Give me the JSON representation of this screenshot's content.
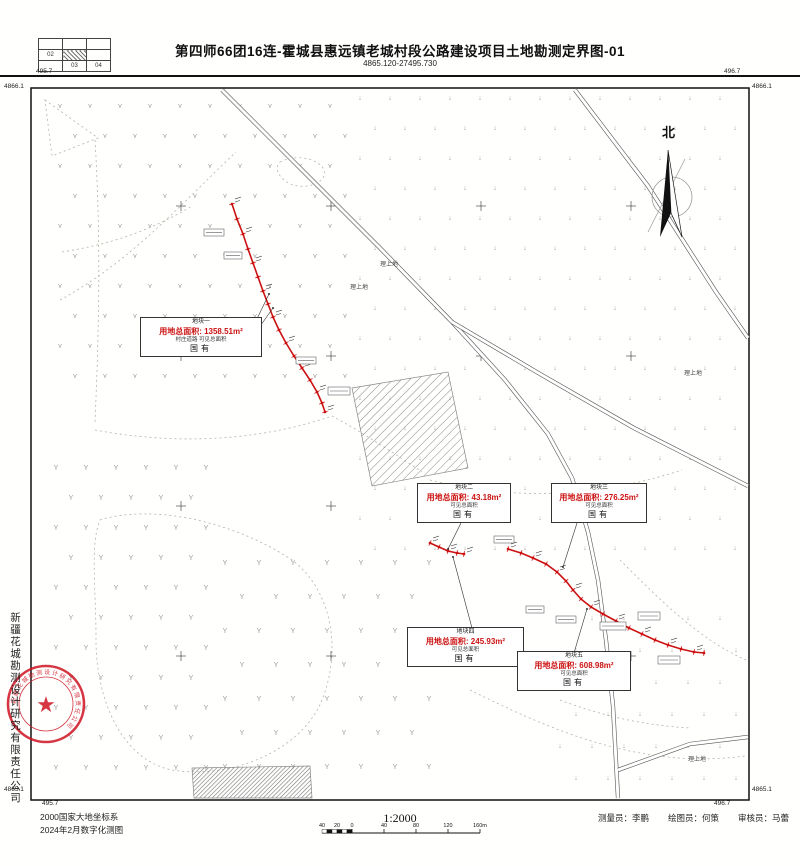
{
  "header": {
    "cells": [
      "02",
      "03",
      "04"
    ],
    "title": "第四师66团16连-霍城县惠远镇老城村段公路建设项目土地勘测定界图-01",
    "subtitle": "4865.120-27495.730"
  },
  "north_label": "北",
  "company_vertical": "新疆花城勘测设计研究有限责任公司",
  "seal": {
    "ring_text": "新疆花城勘测设计研究有限责任公司",
    "star": "★"
  },
  "corners": {
    "top_left_top": "495.7",
    "top_left_side": "4866.1",
    "top_right_top": "496.7",
    "top_right_side": "4866.1",
    "bottom_left_side": "4865.1",
    "bottom_left_bottom": "495.7",
    "bottom_right_side": "4865.1",
    "bottom_right_bottom": "496.7"
  },
  "footer": {
    "crs": "2000国家大地坐标系",
    "survey_date": "2024年2月数字化测图",
    "scale_text": "1:2000",
    "scale_ticks": [
      "40",
      "20",
      "0",
      "40",
      "80",
      "120",
      "160m"
    ],
    "surveyor_label": "测量员：李鹏",
    "drafter_label": "绘图员：何策",
    "reviewer_label": "审核员：马蕾"
  },
  "parcels": [
    {
      "name": "地块一",
      "area": "用地总面积: 1358.51m²",
      "sub": "村庄道路 可见总面积",
      "tenure": "国有",
      "x": 140,
      "y": 317,
      "w": 116,
      "h": 45
    },
    {
      "name": "地块二",
      "area": "用地总面积: 43.18m²",
      "sub": "可见总面积",
      "tenure": "国有",
      "x": 417,
      "y": 483,
      "w": 88,
      "h": 43
    },
    {
      "name": "地块三",
      "area": "用地总面积: 276.25m²",
      "sub": "可见总面积",
      "tenure": "国有",
      "x": 551,
      "y": 483,
      "w": 90,
      "h": 43
    },
    {
      "name": "地块四",
      "area": "用地总面积: 245.93m²",
      "sub": "可见总面积",
      "tenure": "国有",
      "x": 407,
      "y": 627,
      "w": 111,
      "h": 45
    },
    {
      "name": "地块五",
      "area": "用地总面积: 608.98m²",
      "sub": "可见总面积",
      "tenure": "国有",
      "x": 517,
      "y": 651,
      "w": 108,
      "h": 47
    }
  ],
  "land_labels": [
    {
      "text": "理上地",
      "x": 380,
      "y": 259
    },
    {
      "text": "理上地",
      "x": 350,
      "y": 282
    },
    {
      "text": "理上地",
      "x": 684,
      "y": 368
    },
    {
      "text": "理上地",
      "x": 688,
      "y": 754
    }
  ],
  "colors": {
    "route_red": "#cc1111",
    "seal_red": "#cf1322",
    "road_gray": "#555",
    "symbol_gray": "#9a9a9a"
  },
  "map": {
    "frame": {
      "x": 31,
      "y": 88,
      "w": 718,
      "h": 712
    },
    "symbol_regions": [
      {
        "glyph": "⋎",
        "x0": 60,
        "y0": 108,
        "x1": 345,
        "y1": 385,
        "step": 30
      },
      {
        "glyph": "↓",
        "x0": 360,
        "y0": 100,
        "x1": 742,
        "y1": 560,
        "step": 30
      },
      {
        "glyph": "↓",
        "x0": 560,
        "y0": 620,
        "x1": 742,
        "y1": 795,
        "step": 32
      },
      {
        "glyph": "Y",
        "x0": 56,
        "y0": 470,
        "x1": 210,
        "y1": 795,
        "step": 30
      },
      {
        "glyph": "Y",
        "x0": 225,
        "y0": 565,
        "x1": 430,
        "y1": 790,
        "step": 34
      }
    ],
    "grid_crosses": {
      "xs": [
        181,
        331,
        481,
        631
      ],
      "ys": [
        206,
        356,
        506,
        656
      ]
    },
    "roads": [
      "M222,90 L300,168 L380,248 L452,322 L505,380 L548,434 L572,478 L588,532 L598,580 L606,640 L613,706 L618,798",
      "M452,322 L540,374 L634,428 L748,486",
      "M575,90 L648,186 L716,292 L748,338",
      "M618,770 L690,744 L748,737"
    ],
    "dashed_paths": [
      "M60,300 C130,262 180,205 236,152",
      "M62,252 C112,244 152,230 192,206",
      "M95,140 C101,240 99,330 95,422",
      "M95,430 C180,446 262,440 332,416",
      "M332,416 C362,432 392,452 422,472",
      "M100,520 C150,504 232,520 292,560 C332,590 342,650 322,700 C302,750 232,780 172,770 C122,760 96,700 96,640 C96,588 90,544 100,520 Z",
      "M430,480 C520,502 602,496 682,470",
      "M470,690 C550,730 642,770 745,756",
      "M620,560 C660,600 700,640 746,660",
      "M280,162 C295,154 316,158 323,168 C329,178 316,188 298,186 C283,184 272,170 280,162 Z",
      "M45,100 L98,138 L52,156 Z",
      "M560,700 C600,715 640,725 690,728"
    ],
    "hatch_fields": [
      {
        "points": "352,388 448,372 468,468 372,486",
        "pattern": "hatchLight"
      },
      {
        "points": "192,768 310,766 312,798 194,798",
        "pattern": "hatchDense"
      }
    ],
    "routes": [
      {
        "points": [
          [
            232,
            204
          ],
          [
            237,
            219
          ],
          [
            243,
            234
          ],
          [
            248,
            249
          ],
          [
            253,
            263
          ],
          [
            258,
            277
          ],
          [
            263,
            291
          ],
          [
            268,
            304
          ],
          [
            273,
            317
          ],
          [
            279,
            330
          ],
          [
            286,
            343
          ],
          [
            294,
            356
          ],
          [
            302,
            368
          ],
          [
            310,
            380
          ],
          [
            317,
            392
          ],
          [
            322,
            403
          ],
          [
            325,
            412
          ]
        ]
      },
      {
        "points": [
          [
            430,
            543
          ],
          [
            439,
            547
          ],
          [
            448,
            551
          ],
          [
            457,
            553
          ],
          [
            464,
            554
          ]
        ]
      },
      {
        "points": [
          [
            508,
            549
          ],
          [
            521,
            553
          ],
          [
            533,
            558
          ],
          [
            546,
            564
          ],
          [
            557,
            572
          ],
          [
            566,
            581
          ],
          [
            573,
            590
          ],
          [
            581,
            599
          ],
          [
            591,
            607
          ],
          [
            603,
            614
          ],
          [
            616,
            621
          ],
          [
            629,
            628
          ],
          [
            642,
            634
          ],
          [
            655,
            640
          ],
          [
            668,
            645
          ],
          [
            681,
            649
          ],
          [
            694,
            652
          ],
          [
            704,
            653
          ]
        ]
      }
    ],
    "leaders": [
      [
        253,
        327,
        269,
        294
      ],
      [
        253,
        336,
        273,
        308
      ],
      [
        461,
        523,
        448,
        549
      ],
      [
        577,
        523,
        563,
        567
      ],
      [
        472,
        628,
        453,
        557
      ],
      [
        574,
        653,
        587,
        609
      ]
    ],
    "micro_boxes": [
      [
        600,
        622,
        26,
        8
      ],
      [
        638,
        612,
        22,
        8
      ],
      [
        556,
        616,
        20,
        7
      ],
      [
        526,
        606,
        18,
        7
      ],
      [
        658,
        656,
        22,
        8
      ],
      [
        224,
        252,
        18,
        7
      ],
      [
        204,
        229,
        20,
        7
      ],
      [
        296,
        357,
        20,
        7
      ],
      [
        328,
        387,
        22,
        8
      ],
      [
        494,
        536,
        20,
        7
      ]
    ],
    "north": {
      "lx": 672,
      "ly": 134,
      "cx": 672,
      "cy": 197
    },
    "seal": {
      "cx": 46,
      "cy": 704,
      "r_outer": 38,
      "r_inner": 27,
      "r_text": 30
    },
    "scale_bar": {
      "x0": 322,
      "x1": 480,
      "y": 833
    }
  }
}
